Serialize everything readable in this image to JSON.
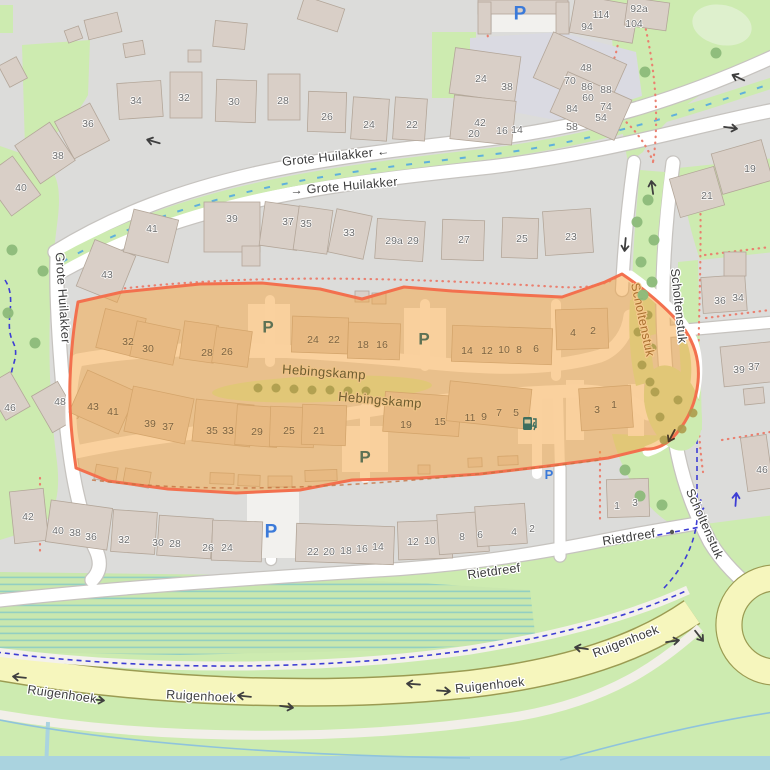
{
  "map": {
    "style": "openstreetmap-carto",
    "highlight_area": {
      "name": "Hebingskamp",
      "fill": "rgba(246,163,61,0.5)",
      "border": "#f3704e"
    },
    "street_labels": [
      {
        "t": "Grote Huilakker ←",
        "x": 336,
        "y": 157,
        "r": -6,
        "s": "street"
      },
      {
        "t": "→ Grote Huilakker",
        "x": 344,
        "y": 187,
        "r": -5,
        "s": "street"
      },
      {
        "t": "Grote Huilakker",
        "x": 62,
        "y": 298,
        "r": 86,
        "s": "street"
      },
      {
        "t": "Scholtenstuk",
        "x": 678,
        "y": 306,
        "r": 84,
        "s": "street"
      },
      {
        "t": "Scholtenstuk",
        "x": 704,
        "y": 524,
        "r": 66,
        "s": "street"
      },
      {
        "t": "Scholtenstuk",
        "x": 642,
        "y": 320,
        "r": 78,
        "s": "street-hl"
      },
      {
        "t": "Hebingskamp",
        "x": 324,
        "y": 373,
        "r": 4,
        "s": "street-hl2"
      },
      {
        "t": "Hebingskamp",
        "x": 380,
        "y": 401,
        "r": 5,
        "s": "street-hl2"
      },
      {
        "t": "Rietdreef",
        "x": 494,
        "y": 572,
        "r": -8,
        "s": "street"
      },
      {
        "t": "Rietdreef",
        "x": 629,
        "y": 538,
        "r": -9,
        "s": "street"
      },
      {
        "t": "Ruigenhoek",
        "x": 62,
        "y": 695,
        "r": 8,
        "s": "street"
      },
      {
        "t": "Ruigenhoek",
        "x": 201,
        "y": 697,
        "r": 3,
        "s": "street"
      },
      {
        "t": "Ruigenhoek",
        "x": 490,
        "y": 686,
        "r": -6,
        "s": "street"
      },
      {
        "t": "Ruigenhoek",
        "x": 626,
        "y": 642,
        "r": -21,
        "s": "street"
      }
    ],
    "house_numbers_gray": [
      [
        "34",
        136,
        101
      ],
      [
        "32",
        184,
        98
      ],
      [
        "30",
        234,
        102
      ],
      [
        "28",
        283,
        101
      ],
      [
        "26",
        327,
        117
      ],
      [
        "24",
        369,
        125
      ],
      [
        "22",
        412,
        125
      ],
      [
        "36",
        88,
        124
      ],
      [
        "38",
        58,
        156
      ],
      [
        "40",
        21,
        188
      ],
      [
        "24",
        481,
        79
      ],
      [
        "38",
        507,
        87
      ],
      [
        "42",
        480,
        123
      ],
      [
        "20",
        474,
        134
      ],
      [
        "16",
        502,
        131
      ],
      [
        "14",
        517,
        130
      ],
      [
        "48",
        586,
        68
      ],
      [
        "70",
        570,
        81
      ],
      [
        "86",
        587,
        87
      ],
      [
        "88",
        606,
        90
      ],
      [
        "60",
        588,
        98
      ],
      [
        "84",
        572,
        109
      ],
      [
        "74",
        606,
        107
      ],
      [
        "54",
        601,
        118
      ],
      [
        "58",
        572,
        127
      ],
      [
        "114",
        601,
        15
      ],
      [
        "94",
        587,
        27
      ],
      [
        "92a",
        639,
        9
      ],
      [
        "104",
        634,
        24
      ],
      [
        "19",
        750,
        169
      ],
      [
        "21",
        707,
        196
      ],
      [
        "41",
        152,
        229
      ],
      [
        "43",
        107,
        275
      ],
      [
        "39",
        232,
        219
      ],
      [
        "37",
        288,
        222
      ],
      [
        "35",
        306,
        224
      ],
      [
        "33",
        349,
        233
      ],
      [
        "29a",
        394,
        241
      ],
      [
        "29",
        413,
        241
      ],
      [
        "27",
        464,
        240
      ],
      [
        "25",
        522,
        239
      ],
      [
        "23",
        571,
        237
      ],
      [
        "36",
        720,
        301
      ],
      [
        "34",
        738,
        298
      ],
      [
        "39",
        739,
        370
      ],
      [
        "37",
        754,
        367
      ],
      [
        "46",
        10,
        408
      ],
      [
        "48",
        60,
        402
      ],
      [
        "46",
        762,
        470
      ],
      [
        "42",
        28,
        517
      ],
      [
        "40",
        58,
        531
      ],
      [
        "38",
        75,
        533
      ],
      [
        "36",
        91,
        537
      ],
      [
        "32",
        124,
        540
      ],
      [
        "30",
        158,
        543
      ],
      [
        "28",
        175,
        544
      ],
      [
        "26",
        208,
        548
      ],
      [
        "24",
        227,
        548
      ],
      [
        "22",
        313,
        552
      ],
      [
        "20",
        329,
        552
      ],
      [
        "18",
        346,
        551
      ],
      [
        "16",
        362,
        549
      ],
      [
        "14",
        378,
        547
      ],
      [
        "12",
        413,
        542
      ],
      [
        "10",
        430,
        541
      ],
      [
        "8",
        462,
        537
      ],
      [
        "6",
        480,
        535
      ],
      [
        "4",
        514,
        532
      ],
      [
        "2",
        532,
        529
      ],
      [
        "1",
        617,
        506
      ],
      [
        "3",
        635,
        503
      ]
    ],
    "house_numbers_highlighted": [
      [
        "32",
        128,
        342
      ],
      [
        "30",
        148,
        349
      ],
      [
        "28",
        207,
        353
      ],
      [
        "26",
        227,
        352
      ],
      [
        "24",
        313,
        340
      ],
      [
        "22",
        334,
        340
      ],
      [
        "18",
        363,
        345
      ],
      [
        "16",
        382,
        345
      ],
      [
        "14",
        467,
        351
      ],
      [
        "12",
        487,
        351
      ],
      [
        "10",
        504,
        350
      ],
      [
        "8",
        519,
        350
      ],
      [
        "6",
        536,
        349
      ],
      [
        "4",
        573,
        333
      ],
      [
        "2",
        593,
        331
      ],
      [
        "43",
        93,
        407
      ],
      [
        "41",
        113,
        412
      ],
      [
        "39",
        150,
        424
      ],
      [
        "37",
        168,
        427
      ],
      [
        "35",
        212,
        431
      ],
      [
        "33",
        228,
        431
      ],
      [
        "29",
        257,
        432
      ],
      [
        "25",
        289,
        431
      ],
      [
        "21",
        319,
        431
      ],
      [
        "19",
        406,
        425
      ],
      [
        "15",
        440,
        422
      ],
      [
        "11",
        470,
        418
      ],
      [
        "9",
        484,
        417
      ],
      [
        "7",
        499,
        413
      ],
      [
        "5",
        516,
        413
      ],
      [
        "3",
        597,
        410
      ],
      [
        "1",
        614,
        405
      ]
    ],
    "parking_blue": [
      [
        520,
        8,
        19
      ],
      [
        271,
        526,
        19
      ],
      [
        549,
        471,
        13
      ]
    ],
    "parking_highlighted": [
      [
        268,
        322,
        17
      ],
      [
        424,
        334,
        17
      ],
      [
        365,
        452,
        17
      ]
    ],
    "ev_charger_icon": {
      "x": 529,
      "y": 424
    },
    "oneway_arrows": [
      [
        152,
        141,
        196
      ],
      [
        737,
        77,
        205
      ],
      [
        732,
        128,
        8
      ],
      [
        652,
        186,
        262
      ],
      [
        625,
        246,
        95
      ],
      [
        700,
        637,
        52
      ],
      [
        18,
        677,
        186
      ],
      [
        99,
        700,
        6
      ],
      [
        243,
        696,
        186
      ],
      [
        288,
        707,
        8
      ],
      [
        412,
        684,
        184
      ],
      [
        445,
        691,
        4
      ],
      [
        580,
        648,
        188
      ],
      [
        674,
        641,
        352
      ]
    ],
    "oneway_arrows_highlighted": [
      [
        671,
        437,
        118
      ]
    ],
    "cycle_arrows": [
      [
        700,
        508,
        95
      ],
      [
        736,
        498,
        274
      ]
    ],
    "bollard": [
      672,
      532
    ],
    "trees_green": [
      [
        12,
        250
      ],
      [
        43,
        271
      ],
      [
        8,
        313
      ],
      [
        35,
        343
      ],
      [
        645,
        72
      ],
      [
        716,
        53
      ],
      [
        648,
        200
      ],
      [
        637,
        222
      ],
      [
        654,
        240
      ],
      [
        641,
        262
      ],
      [
        652,
        282
      ],
      [
        643,
        295
      ],
      [
        625,
        470
      ],
      [
        640,
        496
      ],
      [
        662,
        505
      ]
    ],
    "trees_olive": [
      [
        258,
        388
      ],
      [
        276,
        388
      ],
      [
        294,
        389
      ],
      [
        312,
        390
      ],
      [
        330,
        390
      ],
      [
        348,
        391
      ],
      [
        366,
        391
      ],
      [
        648,
        315
      ],
      [
        638,
        332
      ],
      [
        652,
        348
      ],
      [
        642,
        365
      ],
      [
        650,
        382
      ],
      [
        655,
        392
      ],
      [
        678,
        400
      ],
      [
        693,
        413
      ],
      [
        660,
        417
      ],
      [
        682,
        429
      ],
      [
        664,
        440
      ]
    ],
    "colors": {
      "background": "#dcdcda",
      "green": "#cdebb0",
      "green_light": "#def0cd",
      "road": "#ffffff",
      "road_casing": "#c6c3bf",
      "yellow_road": "#f6f6bd",
      "yellow_casing": "#9b9b52",
      "building": "#d9cfc7",
      "building_line": "#b3a699",
      "plaza": "#dadae2",
      "water": "#aad3df",
      "marsh_stripe": "#92cfc2",
      "foot_path": "#ea8070",
      "cycle_path": "#3d3dd4",
      "ditch": "#5fb0dc",
      "parking_blue": "#3b7ad9",
      "parking_tinted": "#5d7154",
      "tree": "#8cbb7a",
      "tree_olive": "#ad9c4c",
      "ev": "#3e6e5e"
    }
  }
}
